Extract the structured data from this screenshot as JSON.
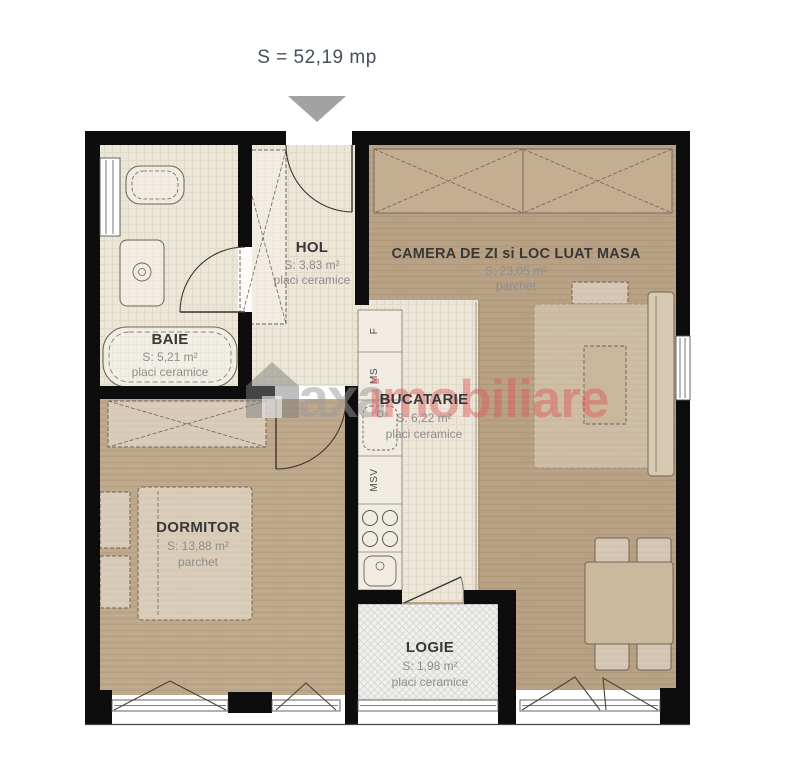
{
  "title": "S = 52,19 mp",
  "rooms": {
    "hol": {
      "name": "HOL",
      "area": "S: 3,83 m²",
      "floor": "placi ceramice"
    },
    "camera": {
      "name": "CAMERA DE ZI si LOC LUAT MASA",
      "area": "S: 23,05 m²",
      "floor": "parchet"
    },
    "baie": {
      "name": "BAIE",
      "area": "S: 5,21 m²",
      "floor": "placi ceramice"
    },
    "bucatarie": {
      "name": "BUCATARIE",
      "area": "S: 6,22 m²",
      "floor": "placi ceramice"
    },
    "dormitor": {
      "name": "DORMITOR",
      "area": "S: 13,88 m²",
      "floor": "parchet"
    },
    "logie": {
      "name": "LOGIE",
      "area": "S: 1,98 m²",
      "floor": "placi ceramice"
    }
  },
  "appliances": {
    "fridge": "F",
    "washer": "MS",
    "dishwasher": "MSV"
  },
  "watermark": {
    "brand": "axa",
    "suffix": "imobiliare",
    "brand_color": "#9a9a9a",
    "suffix_color": "#de5759"
  },
  "colors": {
    "wall": "#0d0d0d",
    "tile_floor": "#ece6d9",
    "parquet_living": "#b7a084",
    "parquet_bedroom": "#bda88c",
    "logie_floor": "#f0efec",
    "title_text": "#475058",
    "label_text": "#383838",
    "sub_text": "#8d8d8d",
    "arrow": "#a2a2a2"
  }
}
